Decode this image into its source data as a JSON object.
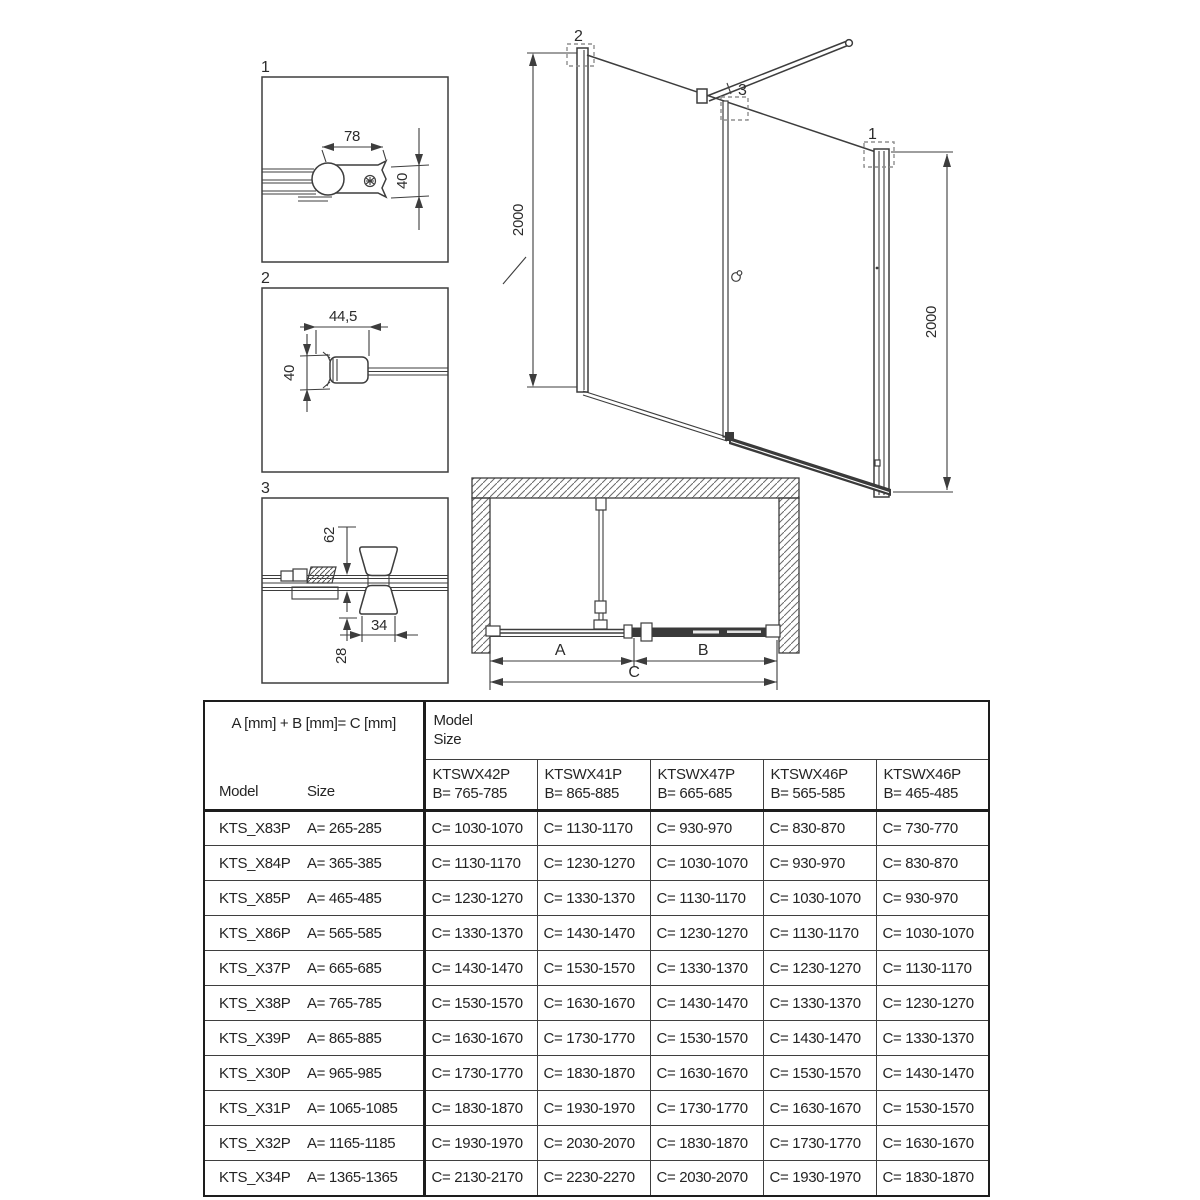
{
  "details": [
    {
      "label": "1",
      "width_dim": "78",
      "height_dim": "40"
    },
    {
      "label": "2",
      "width_dim": "44,5",
      "height_dim": "40"
    },
    {
      "label": "3",
      "top_dim": "62",
      "width_dim": "34",
      "bottom_dim": "28"
    }
  ],
  "elevation": {
    "left_height": "2000",
    "right_height": "2000",
    "callout_1": "1",
    "callout_2": "2",
    "callout_3": "3"
  },
  "plan": {
    "dim_a": "A",
    "dim_b": "B",
    "dim_c": "C"
  },
  "table": {
    "formula": "A [mm] + B [mm]= C [mm]",
    "model_label": "Model",
    "size_label": "Size",
    "group_model": "Model",
    "group_size": "Size",
    "columns": [
      {
        "model": "KTSWX42P",
        "b": "B= 765-785"
      },
      {
        "model": "KTSWX41P",
        "b": "B= 865-885"
      },
      {
        "model": "KTSWX47P",
        "b": "B= 665-685"
      },
      {
        "model": "KTSWX46P",
        "b": "B= 565-585"
      },
      {
        "model": "KTSWX46P",
        "b": "B= 465-485"
      }
    ],
    "rows": [
      {
        "model": "KTS_X83P",
        "a": "A= 265-285",
        "c": [
          "C= 1030-1070",
          "C= 1130-1170",
          "C= 930-970",
          "C= 830-870",
          "C= 730-770"
        ]
      },
      {
        "model": "KTS_X84P",
        "a": "A= 365-385",
        "c": [
          "C= 1130-1170",
          "C= 1230-1270",
          "C= 1030-1070",
          "C= 930-970",
          "C= 830-870"
        ]
      },
      {
        "model": "KTS_X85P",
        "a": "A= 465-485",
        "c": [
          "C= 1230-1270",
          "C= 1330-1370",
          "C= 1130-1170",
          "C= 1030-1070",
          "C= 930-970"
        ]
      },
      {
        "model": "KTS_X86P",
        "a": "A= 565-585",
        "c": [
          "C= 1330-1370",
          "C= 1430-1470",
          "C= 1230-1270",
          "C= 1130-1170",
          "C= 1030-1070"
        ]
      },
      {
        "model": "KTS_X37P",
        "a": "A= 665-685",
        "c": [
          "C= 1430-1470",
          "C= 1530-1570",
          "C= 1330-1370",
          "C= 1230-1270",
          "C= 1130-1170"
        ]
      },
      {
        "model": "KTS_X38P",
        "a": "A= 765-785",
        "c": [
          "C= 1530-1570",
          "C= 1630-1670",
          "C= 1430-1470",
          "C= 1330-1370",
          "C= 1230-1270"
        ]
      },
      {
        "model": "KTS_X39P",
        "a": "A= 865-885",
        "c": [
          "C= 1630-1670",
          "C= 1730-1770",
          "C= 1530-1570",
          "C= 1430-1470",
          "C= 1330-1370"
        ]
      },
      {
        "model": "KTS_X30P",
        "a": "A= 965-985",
        "c": [
          "C= 1730-1770",
          "C= 1830-1870",
          "C= 1630-1670",
          "C= 1530-1570",
          "C= 1430-1470"
        ]
      },
      {
        "model": "KTS_X31P",
        "a": "A= 1065-1085",
        "c": [
          "C= 1830-1870",
          "C= 1930-1970",
          "C= 1730-1770",
          "C= 1630-1670",
          "C= 1530-1570"
        ]
      },
      {
        "model": "KTS_X32P",
        "a": "A= 1165-1185",
        "c": [
          "C= 1930-1970",
          "C= 2030-2070",
          "C= 1830-1870",
          "C= 1730-1770",
          "C= 1630-1670"
        ]
      },
      {
        "model": "KTS_X34P",
        "a": "A= 1365-1365",
        "c": [
          "C= 2130-2170",
          "C= 2230-2270",
          "C= 2030-2070",
          "C= 1930-1970",
          "C= 1830-1870"
        ]
      }
    ]
  },
  "colors": {
    "line": "#3d3d3d",
    "border": "#1d1d1d",
    "text": "#242424",
    "callout": "#8f8f8f"
  }
}
